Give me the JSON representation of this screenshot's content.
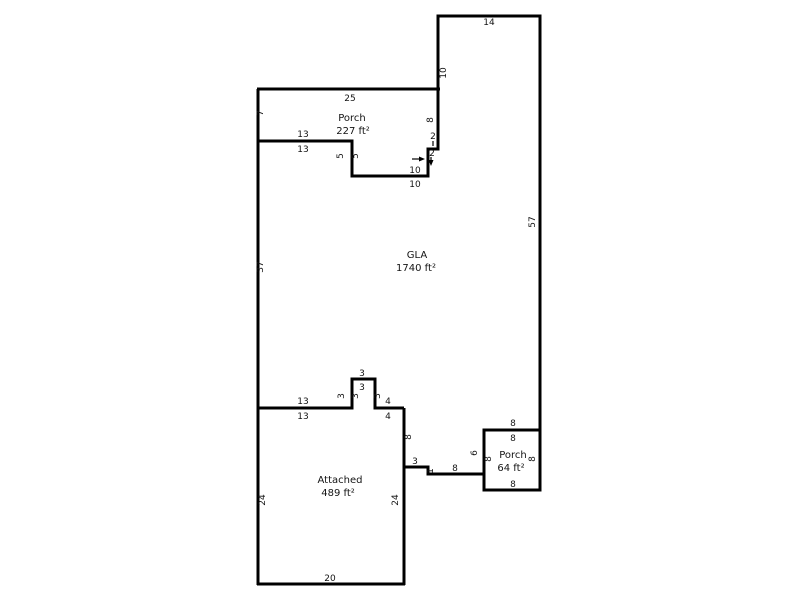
{
  "floorplan": {
    "areas": {
      "porch227": {
        "name": "Porch",
        "area": "227 ft²"
      },
      "gla": {
        "name": "GLA",
        "area": "1740 ft²"
      },
      "attached": {
        "name": "Attached",
        "area": "489 ft²"
      },
      "porch64": {
        "name": "Porch",
        "area": "64 ft²"
      }
    },
    "dims": {
      "top_rect_width": "14",
      "top_rect_left": "10",
      "right_wall": "57",
      "porch_top": "25",
      "porch_left": "7",
      "porch_right": "8",
      "step2_h": "2",
      "step2_v": "2",
      "ledge13_above": "13",
      "ledge13_below": "13",
      "step5_left": "5",
      "step5_right": "5",
      "ledge10_above": "10",
      "ledge10_below": "10",
      "left_wall": "37",
      "bottom13_above": "13",
      "bottom13_below": "13",
      "bump3_top_above": "3",
      "bump3_top_below": "3",
      "bump3_left_outer": "3",
      "bump3_left_inner": "3",
      "bump3_right": "3",
      "seg4_above": "4",
      "seg4_below": "4",
      "drop8": "8",
      "ledge3": "3",
      "drop1": "1",
      "ledge8": "8",
      "porch64_left_outer": "6",
      "porch64_top_above": "8",
      "porch64_top_below": "8",
      "porch64_left_inner": "8",
      "porch64_right_inner": "8",
      "porch64_bottom": "8",
      "garage_left": "24",
      "garage_right": "24",
      "garage_bottom": "20"
    }
  }
}
